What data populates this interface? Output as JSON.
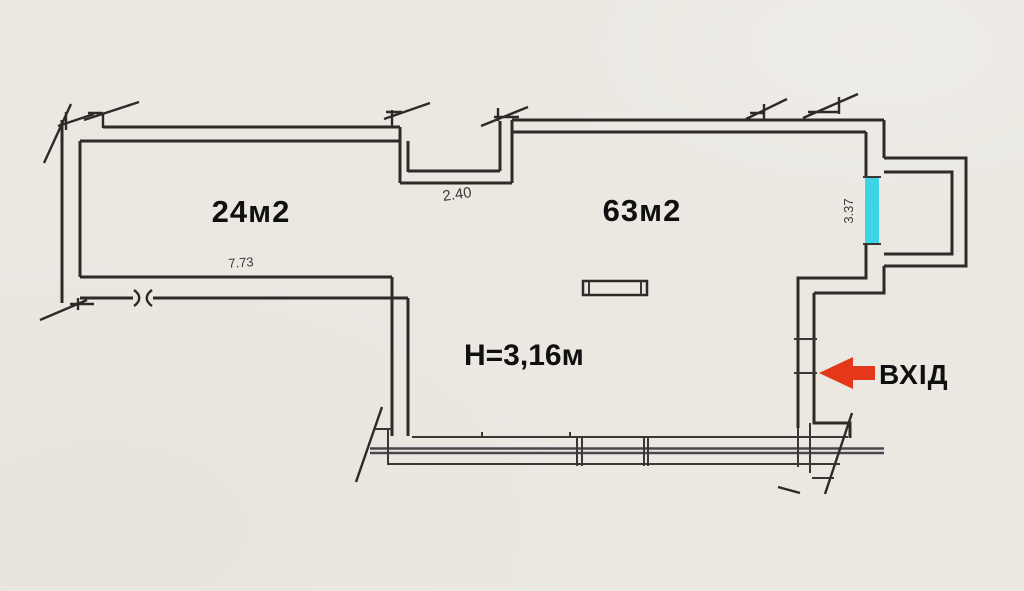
{
  "floor_plan": {
    "rooms": [
      {
        "id": "room-24",
        "area_label": "24м2"
      },
      {
        "id": "room-63",
        "area_label": "63м2",
        "height_label": "H=3,16м"
      }
    ],
    "dimensions": {
      "niche_width_m": "2.40",
      "left_room_width_m": "7.73",
      "window_width_m": "3.37"
    },
    "entrance": {
      "label": "ВХІД",
      "arrow_direction": "left"
    },
    "colors": {
      "paper": "#ebe8e2",
      "ink": "#2d2a27",
      "window_highlight": "#3dd2e4",
      "entrance_arrow": "#e5381b",
      "label_text": "#101010"
    }
  }
}
